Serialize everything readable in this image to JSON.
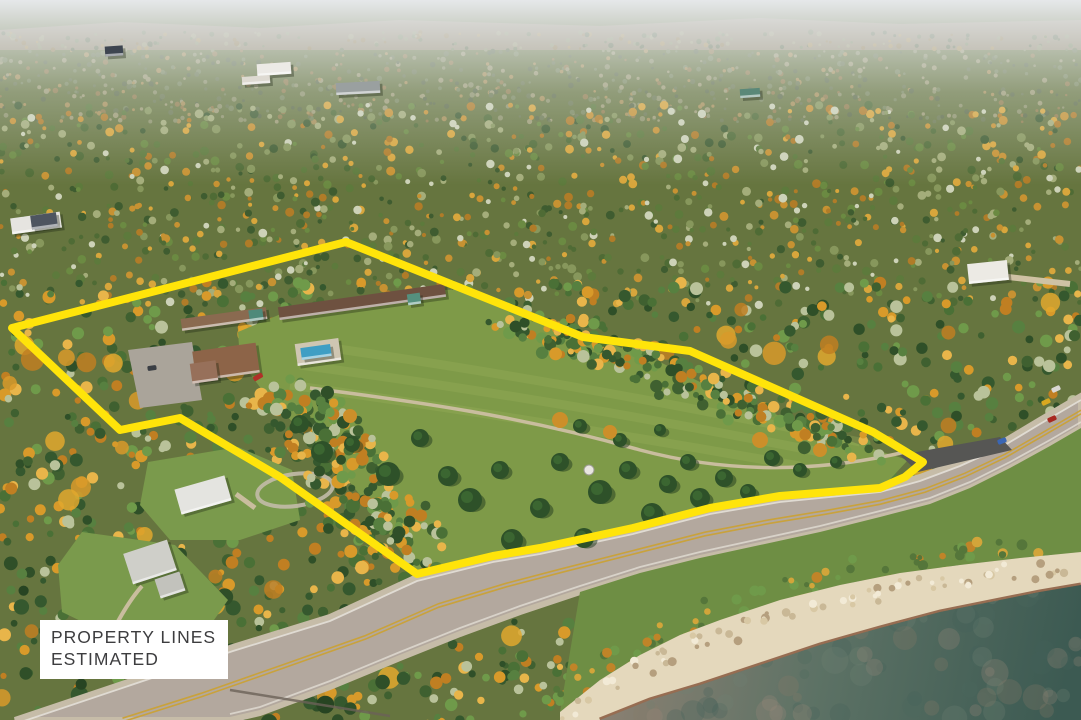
{
  "image": {
    "kind": "aerial-drone-photo",
    "subject": "lakeside resort property in autumn forest beside a highway and Lake Superior shoreline"
  },
  "overlay": {
    "label_line1": "PROPERTY LINES",
    "label_line2": "ESTIMATED",
    "boundary_color": "#FFE40A",
    "boundary_stroke_px": 8,
    "boundary_points": [
      [
        346,
        242
      ],
      [
        583,
        337
      ],
      [
        690,
        351
      ],
      [
        873,
        432
      ],
      [
        923,
        462
      ],
      [
        905,
        477
      ],
      [
        880,
        488
      ],
      [
        780,
        496
      ],
      [
        710,
        508
      ],
      [
        633,
        528
      ],
      [
        540,
        548
      ],
      [
        493,
        556
      ],
      [
        417,
        574
      ],
      [
        280,
        477
      ],
      [
        180,
        418
      ],
      [
        120,
        430
      ],
      [
        12,
        328
      ]
    ]
  },
  "palette": {
    "base_forest": "#66753f",
    "sky_haze": "#e6e8ea",
    "ridge": "#9b8a72",
    "far_trees": [
      "#6b7850",
      "#77855a",
      "#5d6b47",
      "#8c9168",
      "#9c9a72",
      "#a58e55",
      "#8f7b4a"
    ],
    "mid_trees": [
      "#4f6b35",
      "#5d7a3c",
      "#6b8a42",
      "#3f5c30",
      "#c79232",
      "#d8a63c",
      "#b07c28",
      "#87975c",
      "#a4ad7a",
      "#cdd2b8"
    ],
    "near_trees": [
      "#3f6030",
      "#4a7036",
      "#578040",
      "#2f4f28",
      "#d89a2a",
      "#e8b54a",
      "#c07f22",
      "#6f9a4a",
      "#b9c29a",
      "#35582e"
    ],
    "meadow": "#7e9a48",
    "meadow_stripe": "#9ab45c",
    "lawn": "#7a9a4c",
    "road": "#b3a89e",
    "road_shoulder": "#c6bca8",
    "road_line_yellow": "#c9a23c",
    "road_line_white": "#e8e4dc",
    "asphalt_pad": "#565654",
    "gravel_path": "#c9bd9e",
    "grass_verge": "#6e8e44",
    "rock": "#e4d8bc",
    "rock_wet": "#8a5a40",
    "water_shallow": "#8a8072",
    "water_mid": "#5d7265",
    "water_deep": "#3c5a52",
    "conifer": "#2e5129",
    "conifer_shadow": "#20391d"
  },
  "terrain": {
    "road_top_edge": [
      [
        15,
        720
      ],
      [
        143,
        677
      ],
      [
        233,
        647
      ],
      [
        330,
        617
      ],
      [
        417,
        577
      ],
      [
        493,
        558
      ],
      [
        540,
        550
      ],
      [
        633,
        530
      ],
      [
        710,
        510
      ],
      [
        780,
        498
      ],
      [
        830,
        493
      ],
      [
        880,
        488
      ],
      [
        920,
        477
      ],
      [
        960,
        462
      ],
      [
        1000,
        444
      ],
      [
        1040,
        420
      ],
      [
        1081,
        396
      ]
    ],
    "road_bottom_edge": [
      [
        1081,
        428
      ],
      [
        1050,
        446
      ],
      [
        1010,
        468
      ],
      [
        970,
        488
      ],
      [
        930,
        504
      ],
      [
        880,
        517
      ],
      [
        820,
        532
      ],
      [
        760,
        545
      ],
      [
        700,
        558
      ],
      [
        640,
        573
      ],
      [
        580,
        592
      ],
      [
        520,
        612
      ],
      [
        460,
        634
      ],
      [
        400,
        658
      ],
      [
        330,
        687
      ],
      [
        260,
        713
      ],
      [
        230,
        720
      ]
    ],
    "rock_top_edge": [
      [
        560,
        712
      ],
      [
        600,
        680
      ],
      [
        640,
        655
      ],
      [
        680,
        635
      ],
      [
        720,
        620
      ],
      [
        780,
        600
      ],
      [
        840,
        585
      ],
      [
        900,
        573
      ],
      [
        960,
        565
      ],
      [
        1020,
        558
      ],
      [
        1081,
        552
      ]
    ],
    "waterline": [
      [
        600,
        720
      ],
      [
        650,
        700
      ],
      [
        700,
        685
      ],
      [
        760,
        665
      ],
      [
        820,
        645
      ],
      [
        880,
        628
      ],
      [
        940,
        612
      ],
      [
        1000,
        600
      ],
      [
        1040,
        592
      ],
      [
        1081,
        585
      ]
    ],
    "meadow": [
      [
        238,
        332
      ],
      [
        300,
        306
      ],
      [
        360,
        296
      ],
      [
        460,
        289
      ],
      [
        530,
        312
      ],
      [
        600,
        340
      ],
      [
        660,
        362
      ],
      [
        720,
        392
      ],
      [
        800,
        424
      ],
      [
        870,
        448
      ],
      [
        908,
        460
      ],
      [
        880,
        490
      ],
      [
        820,
        496
      ],
      [
        760,
        500
      ],
      [
        700,
        512
      ],
      [
        633,
        532
      ],
      [
        560,
        548
      ],
      [
        500,
        558
      ],
      [
        445,
        568
      ],
      [
        417,
        576
      ],
      [
        380,
        520
      ],
      [
        340,
        470
      ],
      [
        300,
        430
      ],
      [
        262,
        390
      ],
      [
        240,
        360
      ]
    ],
    "lawn_white_house": [
      [
        148,
        462
      ],
      [
        238,
        447
      ],
      [
        292,
        470
      ],
      [
        300,
        520
      ],
      [
        240,
        540
      ],
      [
        170,
        540
      ],
      [
        140,
        505
      ]
    ],
    "lawn_gray_house": [
      [
        82,
        532
      ],
      [
        175,
        545
      ],
      [
        228,
        600
      ],
      [
        200,
        640
      ],
      [
        120,
        640
      ],
      [
        62,
        612
      ],
      [
        58,
        565
      ]
    ],
    "parking_lot": [
      [
        128,
        350
      ],
      [
        192,
        342
      ],
      [
        202,
        400
      ],
      [
        140,
        408
      ]
    ],
    "asphalt_pad_poly": [
      [
        900,
        455
      ],
      [
        1000,
        437
      ],
      [
        1012,
        450
      ],
      [
        918,
        472
      ]
    ],
    "ne_tree_band": [
      [
        505,
        318
      ],
      [
        600,
        348
      ],
      [
        700,
        388
      ],
      [
        790,
        420
      ],
      [
        865,
        448
      ]
    ],
    "west_tree_band": [
      [
        295,
        398
      ],
      [
        335,
        455
      ],
      [
        372,
        510
      ],
      [
        405,
        558
      ]
    ]
  },
  "buildings": [
    {
      "name": "motel-long-building",
      "x": 362,
      "y": 302,
      "w": 168,
      "h": 13,
      "a": -8,
      "c": "#6e5140"
    },
    {
      "name": "motel-west-wing",
      "x": 224,
      "y": 319,
      "w": 86,
      "h": 12,
      "a": -8,
      "c": "#8a6a50"
    },
    {
      "name": "motel-teal-roof-a",
      "x": 256,
      "y": 315,
      "w": 14,
      "h": 11,
      "a": -8,
      "c": "#4e8a7a"
    },
    {
      "name": "motel-teal-roof-b",
      "x": 414,
      "y": 299,
      "w": 13,
      "h": 11,
      "a": -8,
      "c": "#55907e"
    },
    {
      "name": "main-house",
      "x": 226,
      "y": 362,
      "w": 64,
      "h": 30,
      "a": -8,
      "c": "#8d6448"
    },
    {
      "name": "main-house-gable",
      "x": 204,
      "y": 372,
      "w": 26,
      "h": 20,
      "a": -8,
      "c": "#97705a"
    },
    {
      "name": "pool-deck",
      "x": 318,
      "y": 352,
      "w": 44,
      "h": 22,
      "a": -8,
      "c": "#cfc6b2"
    },
    {
      "name": "swimming-pool",
      "x": 316,
      "y": 352,
      "w": 30,
      "h": 12,
      "a": -8,
      "c": "#3f9ec4"
    },
    {
      "name": "white-house",
      "x": 203,
      "y": 495,
      "w": 52,
      "h": 26,
      "a": -16,
      "c": "#e4e4e0"
    },
    {
      "name": "gray-house",
      "x": 150,
      "y": 562,
      "w": 46,
      "h": 32,
      "a": -18,
      "c": "#cfcfc9"
    },
    {
      "name": "gray-house-wing",
      "x": 170,
      "y": 585,
      "w": 26,
      "h": 20,
      "a": -18,
      "c": "#c2c2bc"
    },
    {
      "name": "left-edge-house",
      "x": 36,
      "y": 223,
      "w": 50,
      "h": 16,
      "a": -8,
      "c": "#e6e4e0"
    },
    {
      "name": "left-edge-house-solar-roof",
      "x": 44,
      "y": 221,
      "w": 26,
      "h": 14,
      "a": -8,
      "c": "#4e5560"
    },
    {
      "name": "distant-white-building",
      "x": 274,
      "y": 69,
      "w": 34,
      "h": 12,
      "a": -4,
      "c": "#eceae6"
    },
    {
      "name": "distant-white-building-2",
      "x": 256,
      "y": 80,
      "w": 28,
      "h": 8,
      "a": -4,
      "c": "#dedad2"
    },
    {
      "name": "distant-gray-building",
      "x": 358,
      "y": 88,
      "w": 44,
      "h": 12,
      "a": -3,
      "c": "#9aa0a0"
    },
    {
      "name": "distant-dark-building",
      "x": 114,
      "y": 51,
      "w": 18,
      "h": 10,
      "a": -4,
      "c": "#3d4550"
    },
    {
      "name": "neighbor-white-house",
      "x": 988,
      "y": 272,
      "w": 40,
      "h": 20,
      "a": -6,
      "c": "#eceae4"
    },
    {
      "name": "distant-teal-cabin",
      "x": 750,
      "y": 93,
      "w": 20,
      "h": 9,
      "a": -4,
      "c": "#5a8878"
    }
  ],
  "vehicles": [
    {
      "name": "red-car-yard",
      "x": 258,
      "y": 377,
      "w": 10,
      "h": 5,
      "a": -30,
      "c": "#b03028"
    },
    {
      "name": "dark-car-lot",
      "x": 152,
      "y": 368,
      "w": 9,
      "h": 5,
      "a": -8,
      "c": "#3a3e44"
    },
    {
      "name": "blue-car-road",
      "x": 1002,
      "y": 441,
      "w": 9,
      "h": 5,
      "a": -22,
      "c": "#3a66b4"
    },
    {
      "name": "red-car-road",
      "x": 1052,
      "y": 419,
      "w": 9,
      "h": 5,
      "a": -25,
      "c": "#a82820"
    },
    {
      "name": "yellow-car-road",
      "x": 1046,
      "y": 402,
      "w": 9,
      "h": 5,
      "a": -25,
      "c": "#d8a820"
    },
    {
      "name": "white-car-road",
      "x": 1056,
      "y": 389,
      "w": 9,
      "h": 5,
      "a": -25,
      "c": "#dad8d4"
    }
  ],
  "vegetation": {
    "conifers": [
      [
        300,
        424,
        9
      ],
      [
        322,
        452,
        11
      ],
      [
        352,
        444,
        8
      ],
      [
        388,
        474,
        12
      ],
      [
        420,
        438,
        9
      ],
      [
        448,
        476,
        10
      ],
      [
        470,
        500,
        12
      ],
      [
        500,
        470,
        9
      ],
      [
        512,
        540,
        11
      ],
      [
        540,
        508,
        10
      ],
      [
        560,
        462,
        9
      ],
      [
        584,
        538,
        10
      ],
      [
        600,
        492,
        12
      ],
      [
        628,
        470,
        9
      ],
      [
        652,
        514,
        11
      ],
      [
        668,
        484,
        9
      ],
      [
        688,
        462,
        8
      ],
      [
        700,
        498,
        10
      ],
      [
        724,
        478,
        9
      ],
      [
        748,
        492,
        8
      ],
      [
        772,
        458,
        8
      ],
      [
        800,
        470,
        7
      ],
      [
        580,
        426,
        7
      ],
      [
        620,
        440,
        7
      ],
      [
        660,
        430,
        6
      ],
      [
        836,
        462,
        6
      ]
    ],
    "autumn_blobs": [
      [
        560,
        420,
        8
      ],
      [
        610,
        432,
        7
      ],
      [
        760,
        440,
        8
      ],
      [
        820,
        450,
        7
      ],
      [
        350,
        416,
        7
      ]
    ]
  }
}
